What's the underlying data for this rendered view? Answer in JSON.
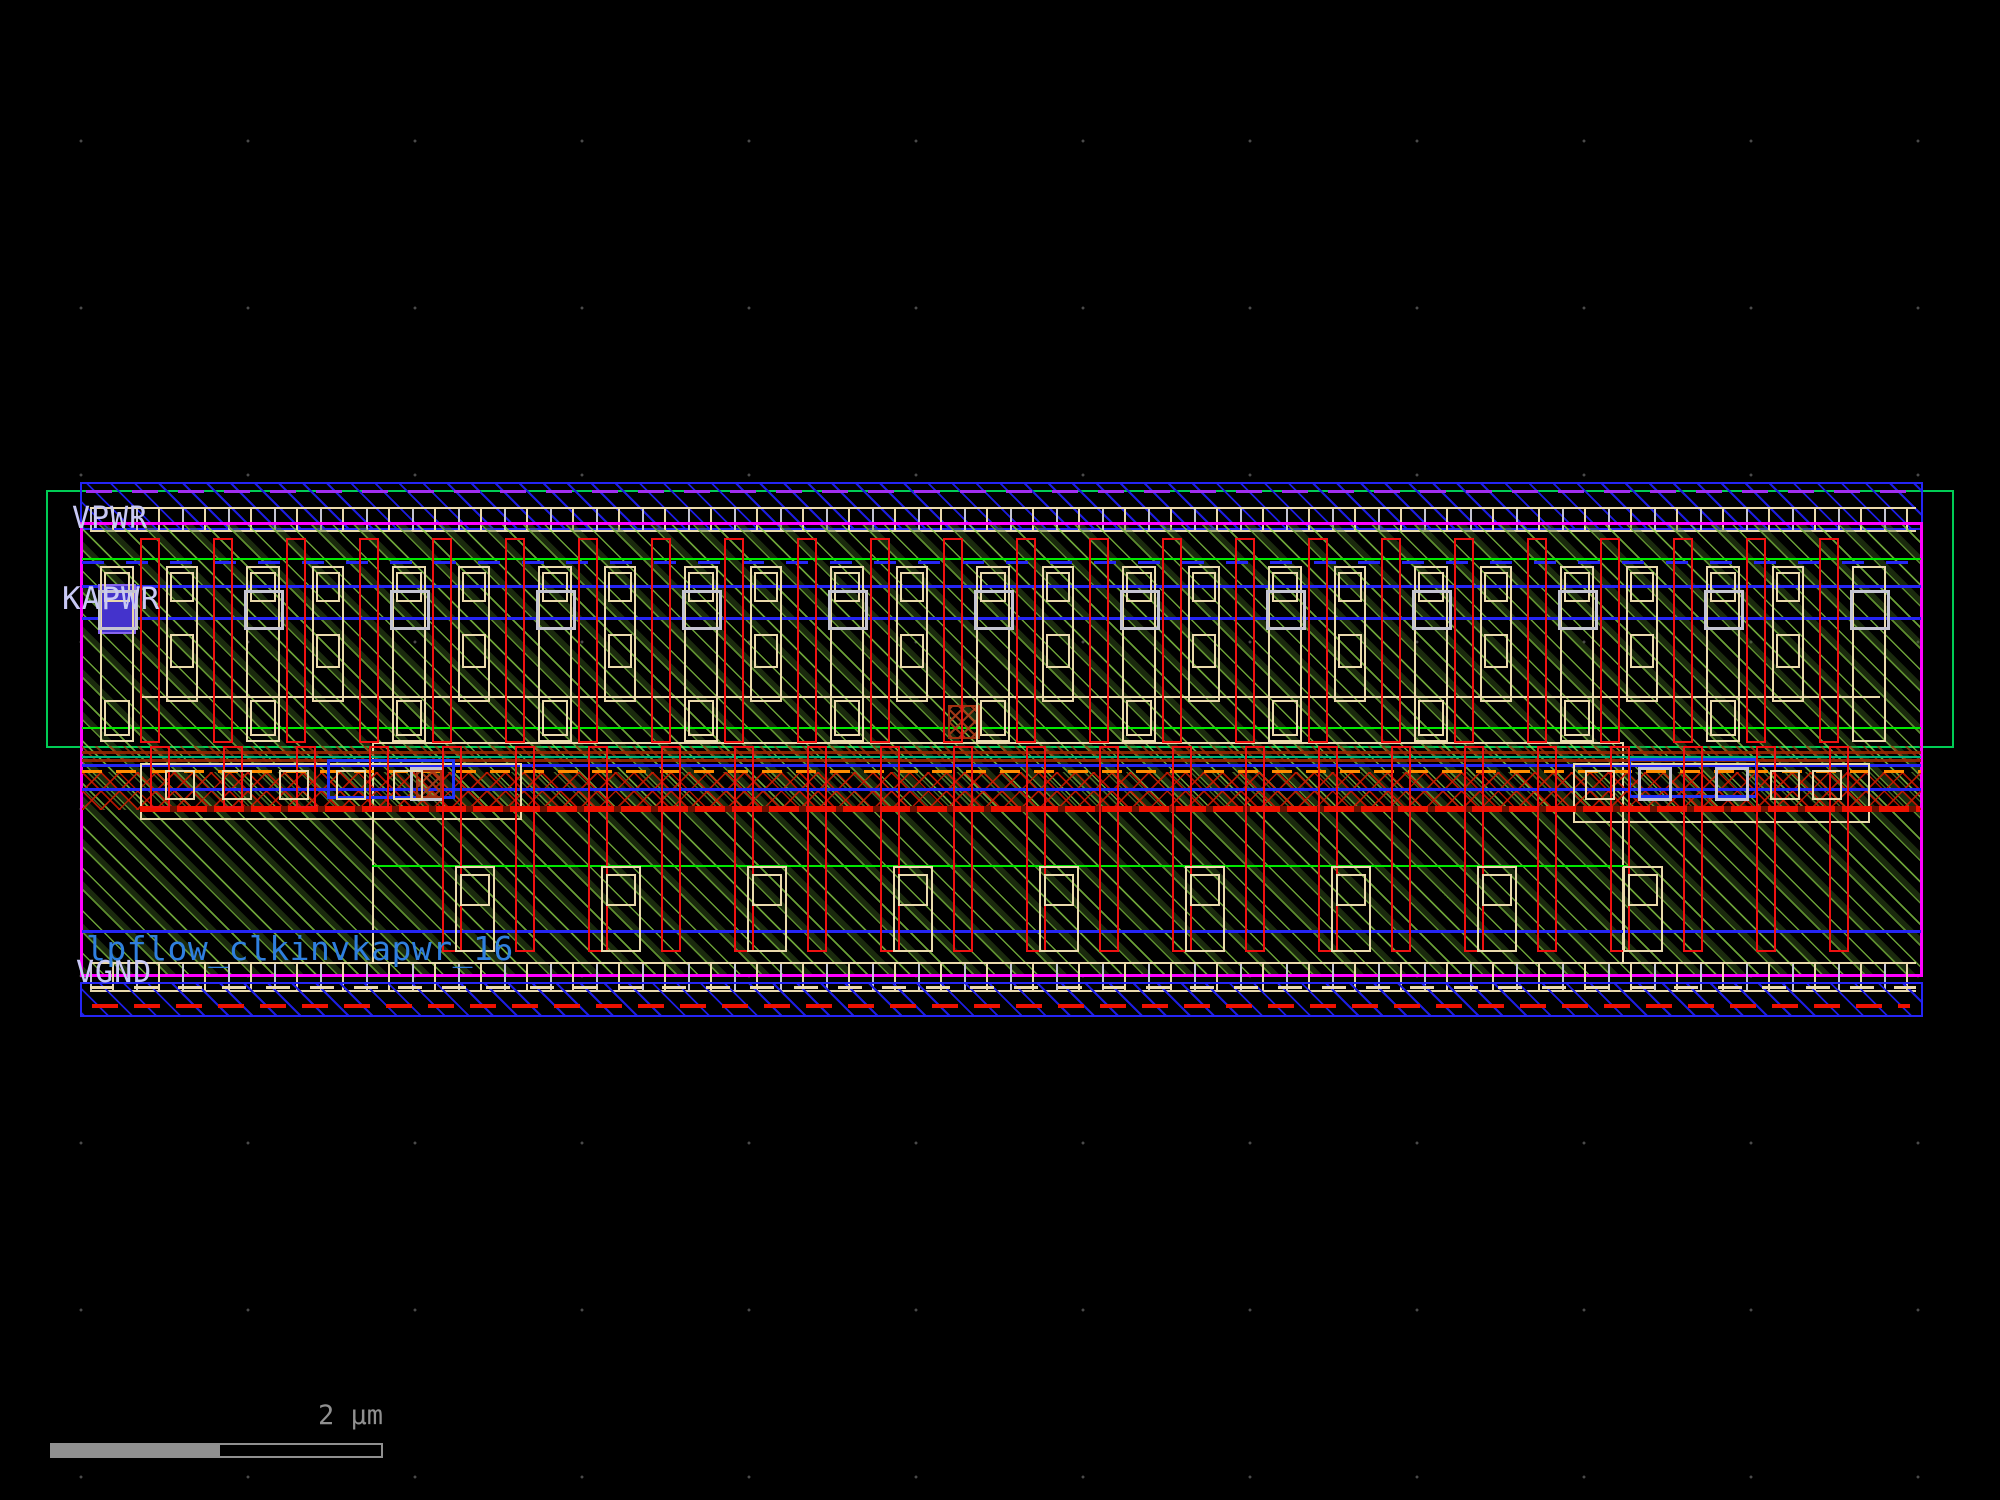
{
  "app": {
    "name": "vlsi-layout-viewer"
  },
  "labels": {
    "vpwr": "VPWR",
    "kapwr": "KAPWR",
    "vgnd": "VGND",
    "cell_name": "lpflow_clkinvkapwr_16"
  },
  "scalebar": {
    "label": "2 µm"
  },
  "colors": {
    "bg": "#000000",
    "grid_dot": "#4a4a4a",
    "blue": "#2525f5",
    "blue_hatch": "#1d1de0",
    "purple": "#a22ef0",
    "magenta": "#ff00ff",
    "well_green": "#00cc55",
    "bright_green": "#00e800",
    "hatch_green": "#8fd54a",
    "poly_red": "#ee1111",
    "brick": "#a03010",
    "bar_red": "#ee1100",
    "orange": "#ff8c00",
    "tan": "#ead9ac",
    "contact_gray": "#c4c4d2",
    "label_lavender": "#c9c9f5",
    "label_blue": "#2f7fdf",
    "scale_gray": "#909090"
  },
  "geometry": {
    "well": {
      "x": 46,
      "y": 490,
      "w": 1908,
      "h": 258
    },
    "top_band": {
      "x": 80,
      "y": 482,
      "w": 1843,
      "h": 48
    },
    "bottom_band": {
      "x": 80,
      "y": 982,
      "w": 1843,
      "h": 35
    },
    "cell": {
      "x": 80,
      "y": 522,
      "w": 1843,
      "h": 455
    },
    "upper_fingers": {
      "x0": 140,
      "pitch": 73,
      "count": 24,
      "y": 538,
      "h": 205,
      "w": 20
    },
    "lower_fingers": {
      "x0": 442,
      "pitch": 73,
      "count": 20,
      "y": 746,
      "h": 206,
      "w": 20
    },
    "lower_stubs": {
      "x0": 150,
      "pitch": 73,
      "count": 4,
      "y": 746,
      "h": 62,
      "w": 20
    },
    "upper_units": {
      "x0": 100,
      "pitch": 146,
      "count": 12,
      "extra_x": 1852
    },
    "lower_units": {
      "x0": 455,
      "pitch": 146,
      "count": 9
    },
    "mid_left_squares": {
      "x0": 165,
      "pitch": 57,
      "count": 5,
      "y": 770,
      "s": 30
    },
    "mid_right_squares": {
      "xs": [
        1585,
        1770,
        1812
      ],
      "y": 770,
      "s": 30
    },
    "mid_right_gray": {
      "xs": [
        1638,
        1715
      ],
      "y": 767,
      "s": 34
    }
  }
}
